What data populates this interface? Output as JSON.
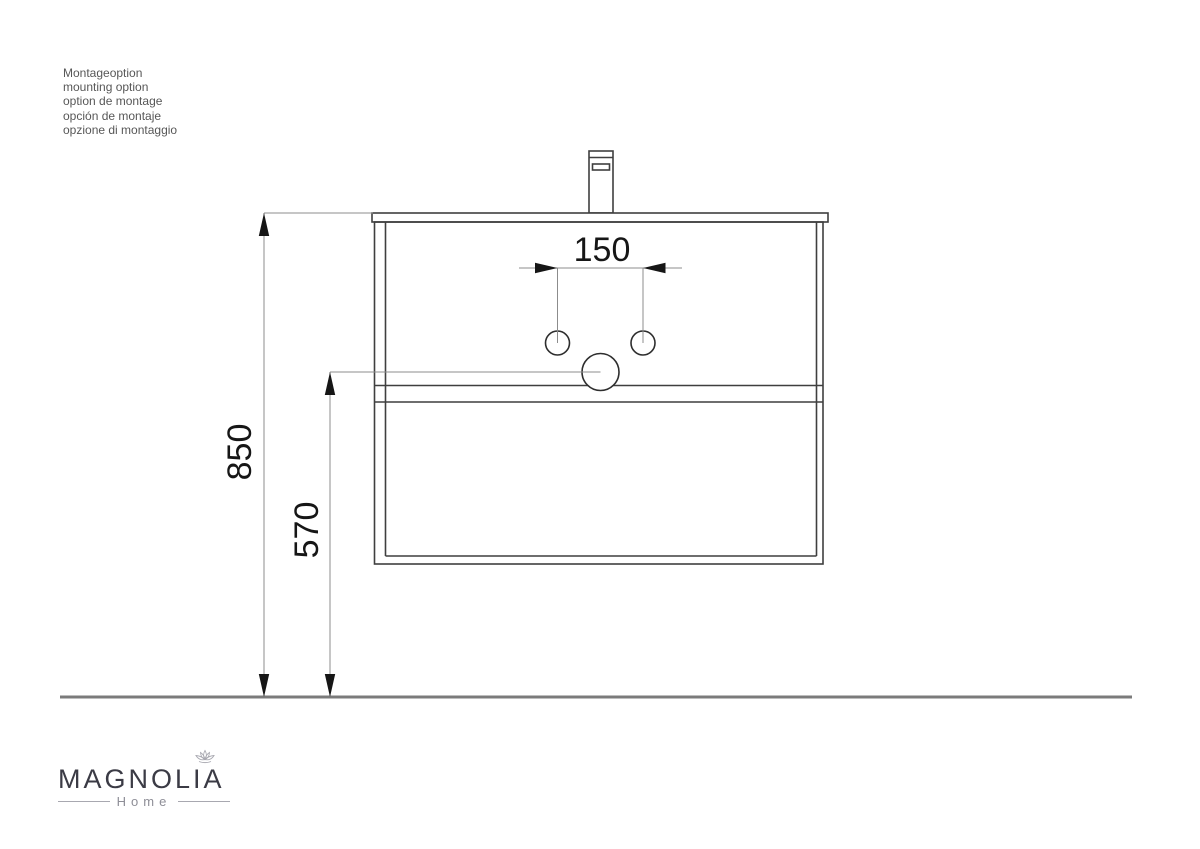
{
  "notes": {
    "lines": [
      "Montageoption",
      "mounting option",
      "option de montage",
      "opción de montaje",
      "opzione di montaggio"
    ]
  },
  "dimensions": {
    "hole_spacing_mm": "150",
    "top_height_mm": "850",
    "drain_height_mm": "570"
  },
  "logo": {
    "brand": "MAGNOLIA",
    "tagline": "Home"
  },
  "colors": {
    "object_line": "#3f3f3f",
    "dimension_line": "#8c8c8c",
    "arrow": "#161616",
    "dimension_text": "#161616",
    "floor_line": "#7b7b7b",
    "note_text": "#575757",
    "logo_text": "#3b3b45",
    "logo_muted": "#8e8e97"
  }
}
